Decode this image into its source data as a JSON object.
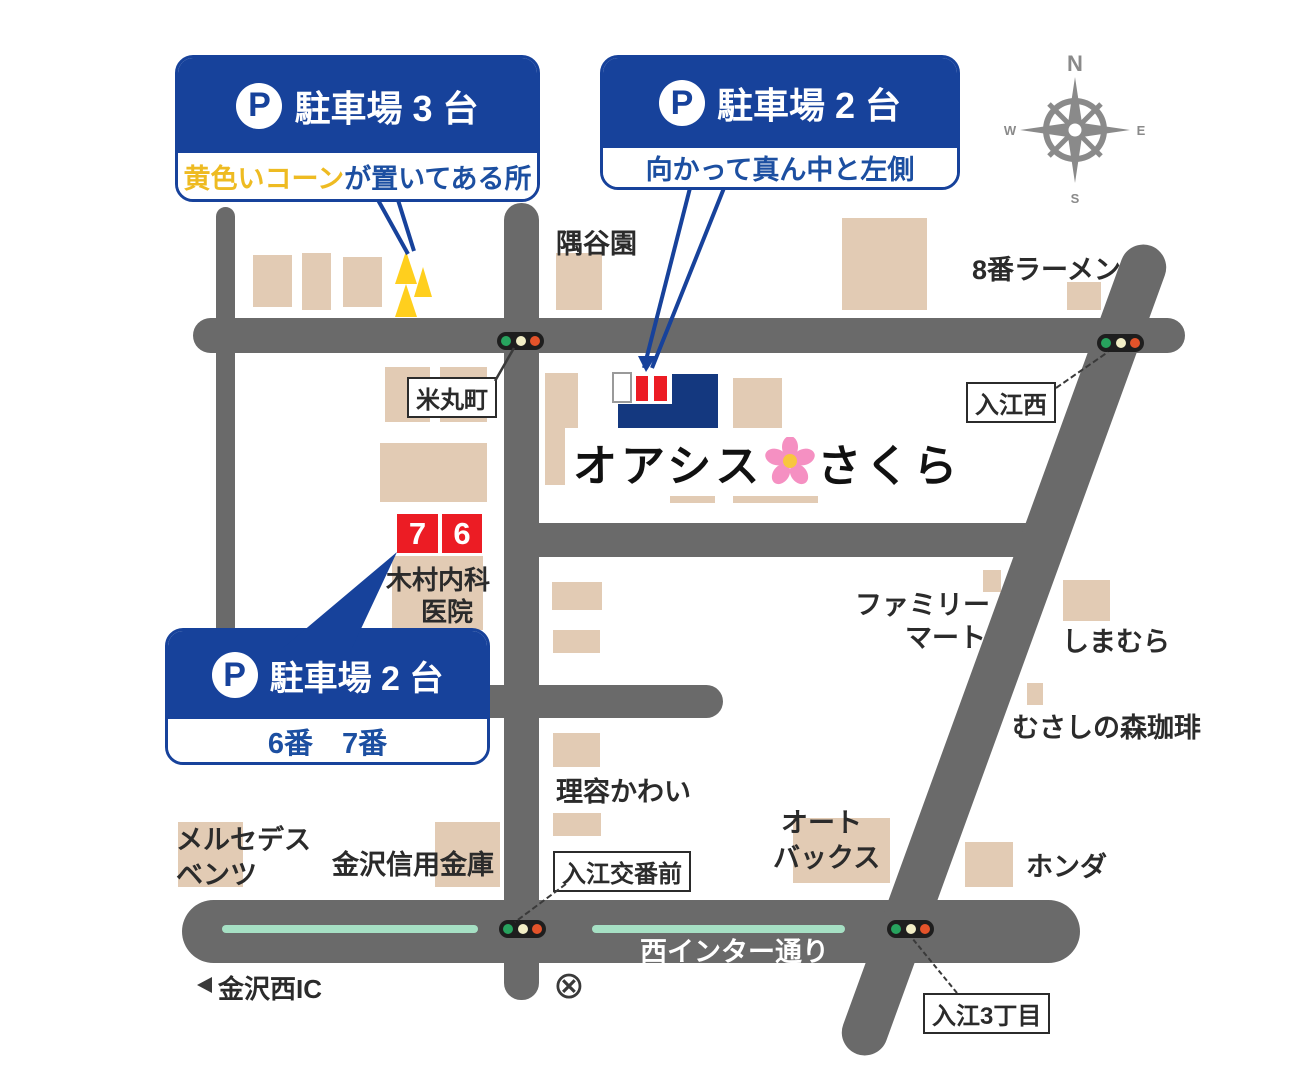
{
  "destination": {
    "name_part1": "オアシス",
    "name_part2": "さくら",
    "flower_icon": "cherry-blossom"
  },
  "callouts": {
    "parking3": {
      "p": "P",
      "title": "駐車場 3 台",
      "note_yellow": "黄色いコーン",
      "note_rest": "が置いてある所"
    },
    "parking2_top": {
      "p": "P",
      "title": "駐車場 2 台",
      "note": "向かって真ん中と左側"
    },
    "parking2_left": {
      "p": "P",
      "title": "駐車場 2 台",
      "note": "6番　7番"
    }
  },
  "parking_spot_numbers": {
    "seven": "7",
    "six": "6"
  },
  "intersections": {
    "yonemarucho": "米丸町",
    "irienishi": "入江西",
    "iriekobanmae": "入江交番前",
    "irie3chome": "入江3丁目"
  },
  "places": {
    "sumiyaen": "隅谷園",
    "hachiban_ramen": "8番ラーメン",
    "family_mart_line1": "ファミリー",
    "family_mart_line2": "マート",
    "shimamura": "しまむら",
    "musashino_mori_coffee": "むさしの森珈琲",
    "riyo_kawai": "理容かわい",
    "autobacs_line1": "オート",
    "autobacs_line2": "バックス",
    "honda": "ホンダ",
    "mercedes_line1": "メルセデス",
    "mercedes_line2": "ベンツ",
    "kanazawa_shinkin_bank": "金沢信用金庫",
    "kimura_clinic_line1": "木村内科",
    "kimura_clinic_line2": "医院",
    "kanazawa_nishi_ic": "金沢西IC"
  },
  "roads": {
    "nishi_inter_dori": "西インター通り"
  },
  "compass": {
    "n": "N",
    "e": "E",
    "s": "S",
    "w": "W"
  },
  "symbols": {
    "crossing": "⊗"
  },
  "colors": {
    "callout_blue": "#17429b",
    "road_gray": "#6a6a6a",
    "building_tan": "#e2cbb4",
    "destination_blue": "#14387f",
    "cone_yellow": "#ffcf1e",
    "highlight_yellow": "#eebb22",
    "marker_red": "#ec1c24",
    "median_mint": "#a6e0c4"
  }
}
